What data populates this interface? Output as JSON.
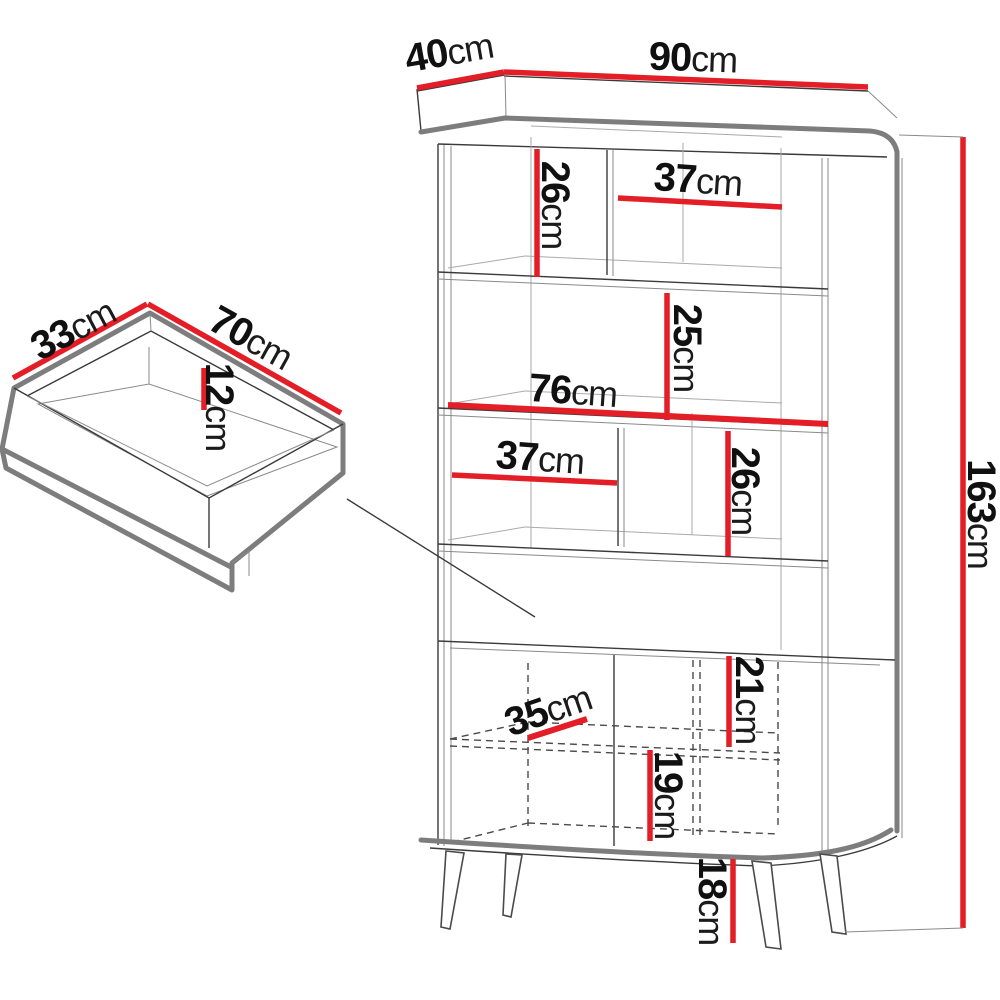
{
  "diagram_title": "Cabinet and drawer dimension drawing",
  "dimensions": {
    "d90": {
      "value": "90",
      "unit": "cm",
      "meaning": "cabinet width"
    },
    "d40": {
      "value": "40",
      "unit": "cm",
      "meaning": "cabinet depth"
    },
    "d163": {
      "value": "163",
      "unit": "cm",
      "meaning": "cabinet total height"
    },
    "d26a": {
      "value": "26",
      "unit": "cm",
      "meaning": "top left compartment height"
    },
    "d37a": {
      "value": "37",
      "unit": "cm",
      "meaning": "top right compartment width"
    },
    "d25": {
      "value": "25",
      "unit": "cm",
      "meaning": "second compartment height"
    },
    "d76": {
      "value": "76",
      "unit": "cm",
      "meaning": "interior width"
    },
    "d37b": {
      "value": "37",
      "unit": "cm",
      "meaning": "third row left compartment width"
    },
    "d26b": {
      "value": "26",
      "unit": "cm",
      "meaning": "third row compartment height"
    },
    "d21": {
      "value": "21",
      "unit": "cm",
      "meaning": "upper compartment behind doors height"
    },
    "d35": {
      "value": "35",
      "unit": "cm",
      "meaning": "compartment behind doors width"
    },
    "d19": {
      "value": "19",
      "unit": "cm",
      "meaning": "lower compartment behind doors height"
    },
    "d18": {
      "value": "18",
      "unit": "cm",
      "meaning": "leg height"
    },
    "d33": {
      "value": "33",
      "unit": "cm",
      "meaning": "drawer depth"
    },
    "d70": {
      "value": "70",
      "unit": "cm",
      "meaning": "drawer width"
    },
    "d12": {
      "value": "12",
      "unit": "cm",
      "meaning": "drawer inner height"
    }
  },
  "colors": {
    "dimension_red": "#e41e26",
    "outline_gray": "#7d7d7d",
    "line_dark": "#3a3a3a",
    "background": "#ffffff"
  }
}
